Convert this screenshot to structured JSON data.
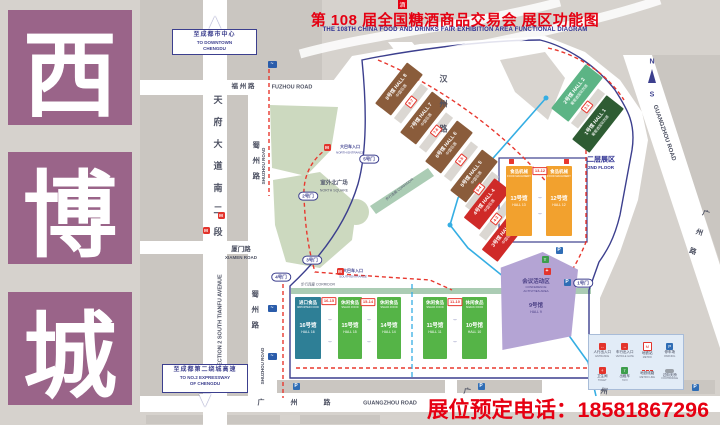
{
  "sidebar": {
    "chars": [
      "西",
      "博",
      "城"
    ],
    "color": "#9a6489"
  },
  "title": {
    "logo_glyph": "酒",
    "cn": "第 108 届全国糖酒商品交易会  展区功能图",
    "en": "THE 108TH CHINA FOOD AND DRINKS FAIR  EXHIBITION AREA FUNCTIONAL DIAGRAM"
  },
  "phone_label": "展位预定电话：18581867296",
  "map": {
    "halls": [
      {
        "id": "8",
        "x": 373,
        "y": 79,
        "w": 52,
        "h": 20,
        "r": -52,
        "color": "#8a5c3b",
        "lines": [
          {
            "t": "8号馆 HALL 8",
            "fs": 5,
            "b": 1
          },
          {
            "t": "中国名酒",
            "fs": 3.8,
            "mt": 1
          }
        ]
      },
      {
        "id": "7",
        "x": 398,
        "y": 108,
        "w": 52,
        "h": 20,
        "r": -52,
        "color": "#8a5c3b",
        "lines": [
          {
            "t": "7号馆 HALL 7",
            "fs": 5,
            "b": 1
          },
          {
            "t": "中国名酒",
            "fs": 3.8,
            "mt": 1
          }
        ]
      },
      {
        "id": "6",
        "x": 423,
        "y": 137,
        "w": 52,
        "h": 20,
        "r": -52,
        "color": "#8a5c3b",
        "lines": [
          {
            "t": "6号馆 HALL 6",
            "fs": 5,
            "b": 1
          },
          {
            "t": "中国名酒",
            "fs": 3.8,
            "mt": 1
          }
        ]
      },
      {
        "id": "5",
        "x": 448,
        "y": 166,
        "w": 52,
        "h": 20,
        "r": -52,
        "color": "#8a5c3b",
        "lines": [
          {
            "t": "5号馆 HALL 5",
            "fs": 5,
            "b": 1
          },
          {
            "t": "中国名酒",
            "fs": 3.8,
            "mt": 1
          }
        ]
      },
      {
        "id": "4",
        "x": 462,
        "y": 194,
        "w": 50,
        "h": 20,
        "r": -52,
        "color": "#cf2a28",
        "lines": [
          {
            "t": "4号馆 HALL 4",
            "fs": 5,
            "b": 1
          },
          {
            "t": "中国名酒",
            "fs": 3.8,
            "mt": 1
          }
        ]
      },
      {
        "id": "3",
        "x": 480,
        "y": 226,
        "w": 50,
        "h": 20,
        "r": -52,
        "color": "#cf2a28",
        "lines": [
          {
            "t": "3号馆 HALL 3",
            "fs": 5,
            "b": 1
          },
          {
            "t": "中国名酒",
            "fs": 3.8,
            "mt": 1
          }
        ]
      },
      {
        "id": "2",
        "x": 549,
        "y": 82,
        "w": 56,
        "h": 22,
        "r": -52,
        "color": "#5cb485",
        "lines": [
          {
            "t": "2号馆 HALL 2",
            "fs": 5,
            "b": 1
          },
          {
            "t": "葡萄酒国际烈酒",
            "fs": 3.6,
            "mt": 1
          }
        ]
      },
      {
        "id": "1",
        "x": 570,
        "y": 113,
        "w": 56,
        "h": 22,
        "r": -52,
        "color": "#2e5c33",
        "lines": [
          {
            "t": "1号馆 HALL 1",
            "fs": 5,
            "b": 1
          },
          {
            "t": "葡萄酒国际烈酒",
            "fs": 3.6,
            "mt": 1
          }
        ]
      },
      {
        "id": "9",
        "x": 494,
        "y": 252,
        "w": 84,
        "h": 98,
        "color": "#b4a4d4",
        "tc": "#4a3f85",
        "clip": "8% 16%, 58% 0%, 100% 18%, 92% 86%, 10% 100%",
        "lines": [
          {
            "t": "会议活动区",
            "fs": 5.5,
            "b": 1,
            "mt": 24
          },
          {
            "t": "CONFERENCE",
            "fs": 3
          },
          {
            "t": "ACTIVITIES AREA",
            "fs": 3
          },
          {
            "t": "9号馆",
            "fs": 5.5,
            "b": 1,
            "mt": 10
          },
          {
            "t": "HALL 9",
            "fs": 3.5
          }
        ]
      },
      {
        "id": "13",
        "x": 506,
        "y": 166,
        "w": 26,
        "h": 70,
        "color": "#f2a12e",
        "lines": [
          {
            "t": "食品机械",
            "fs": 4.5,
            "b": 1
          },
          {
            "t": "FOOD MACHINERY",
            "fs": 2.6
          },
          {
            "t": "13号馆",
            "fs": 5.5,
            "b": 1,
            "mt": 18
          },
          {
            "t": "HALL 13",
            "fs": 3.5
          }
        ]
      },
      {
        "id": "12",
        "x": 546,
        "y": 166,
        "w": 26,
        "h": 70,
        "color": "#f2a12e",
        "lines": [
          {
            "t": "食品机械",
            "fs": 4.5,
            "b": 1
          },
          {
            "t": "FOOD MACHINERY",
            "fs": 2.6
          },
          {
            "t": "12号馆",
            "fs": 5.5,
            "b": 1,
            "mt": 18
          },
          {
            "t": "HALL 12",
            "fs": 3.5
          }
        ]
      },
      {
        "id": "16",
        "x": 295,
        "y": 297,
        "w": 26,
        "h": 62,
        "color": "#2e7f96",
        "lines": [
          {
            "t": "进口食品",
            "fs": 4.5,
            "b": 1
          },
          {
            "t": "IMPORTED FOOD",
            "fs": 2.6
          },
          {
            "t": "16号馆",
            "fs": 5.5,
            "b": 1,
            "mt": 14
          },
          {
            "t": "HALL 16",
            "fs": 3.5
          }
        ]
      },
      {
        "id": "15",
        "x": 338,
        "y": 297,
        "w": 24,
        "h": 62,
        "color": "#55b447",
        "lines": [
          {
            "t": "休闲食品",
            "fs": 4.5,
            "b": 1
          },
          {
            "t": "SNACK FOOD",
            "fs": 2.6
          },
          {
            "t": "15号馆",
            "fs": 5.5,
            "b": 1,
            "mt": 14
          },
          {
            "t": "HALL 15",
            "fs": 3.5
          }
        ]
      },
      {
        "id": "14",
        "x": 377,
        "y": 297,
        "w": 24,
        "h": 62,
        "color": "#55b447",
        "lines": [
          {
            "t": "休闲食品",
            "fs": 4.5,
            "b": 1
          },
          {
            "t": "SNACK FOOD",
            "fs": 2.6
          },
          {
            "t": "14号馆",
            "fs": 5.5,
            "b": 1,
            "mt": 14
          },
          {
            "t": "HALL 14",
            "fs": 3.5
          }
        ]
      },
      {
        "id": "11",
        "x": 423,
        "y": 297,
        "w": 24,
        "h": 62,
        "color": "#55b447",
        "lines": [
          {
            "t": "休闲食品",
            "fs": 4.5,
            "b": 1
          },
          {
            "t": "SNACK FOOD",
            "fs": 2.6
          },
          {
            "t": "11号馆",
            "fs": 5.5,
            "b": 1,
            "mt": 14
          },
          {
            "t": "HALL 11",
            "fs": 3.5
          }
        ]
      },
      {
        "id": "10",
        "x": 462,
        "y": 297,
        "w": 25,
        "h": 62,
        "color": "#55b447",
        "lines": [
          {
            "t": "休闲食品",
            "fs": 4.5,
            "b": 1
          },
          {
            "t": "SNACK FOOD",
            "fs": 2.6
          },
          {
            "t": "10号馆",
            "fs": 5.5,
            "b": 1,
            "mt": 14
          },
          {
            "t": "HALL 10",
            "fs": 3.5
          }
        ]
      }
    ],
    "strips": [
      {
        "x": 411,
        "y": 103,
        "r": -52
      },
      {
        "x": 436,
        "y": 132,
        "r": -52
      },
      {
        "x": 461,
        "y": 161,
        "r": -52
      },
      {
        "x": 482,
        "y": 191,
        "r": -52
      },
      {
        "x": 496,
        "y": 220,
        "r": -52
      },
      {
        "x": 588,
        "y": 108,
        "r": -52
      }
    ],
    "connectors": [
      {
        "t": "16-15",
        "x": 329,
        "y": 301
      },
      {
        "t": "15-14",
        "x": 368,
        "y": 302
      },
      {
        "t": "11-10",
        "x": 455,
        "y": 302
      },
      {
        "t": "13-12",
        "x": 540,
        "y": 171
      },
      {
        "t": "2-1",
        "x": 587,
        "y": 107,
        "r": -52
      },
      {
        "t": "8-7",
        "x": 411,
        "y": 102,
        "r": -52
      },
      {
        "t": "7-6",
        "x": 436,
        "y": 131,
        "r": -52
      },
      {
        "t": "6-5",
        "x": 461,
        "y": 160,
        "r": -52
      },
      {
        "t": "5-4",
        "x": 479,
        "y": 189,
        "r": -52
      },
      {
        "t": "4-3",
        "x": 496,
        "y": 219,
        "r": -52
      }
    ],
    "gates": [
      {
        "label": "2号门",
        "x": 308,
        "y": 196
      },
      {
        "label": "3号门",
        "x": 312,
        "y": 260
      },
      {
        "label": "4号门",
        "x": 281,
        "y": 277
      },
      {
        "label": "1号门",
        "x": 583,
        "y": 283
      },
      {
        "label": "5号门",
        "x": 369,
        "y": 159
      }
    ],
    "labels": [
      {
        "t": "福 州 路",
        "x": 243,
        "y": 87,
        "fs": 6.5,
        "b": 1,
        "n": "road-label-fuzhou-cn"
      },
      {
        "t": "FUZHOU ROAD",
        "x": 292,
        "y": 88,
        "fs": 5.5,
        "b": 1,
        "n": "road-label-fuzhou-en"
      },
      {
        "t": "天府大道南二段",
        "x": 217,
        "y": 172,
        "fs": 9,
        "b": 1,
        "vert": 1,
        "ls": 13,
        "n": "road-label-tianfu-cn"
      },
      {
        "t": "SECTION 2 SOUTH TIANFU AVENUE",
        "x": 221,
        "y": 322,
        "fs": 5.5,
        "b": 1,
        "rot": -90,
        "n": "road-label-tianfu-en"
      },
      {
        "t": "蜀州路",
        "x": 256,
        "y": 164,
        "fs": 7.5,
        "b": 1,
        "vert": 1,
        "ls": 8,
        "n": "road-label-shuzhou-upper-cn"
      },
      {
        "t": "SHUZHOU ROAD",
        "x": 264,
        "y": 166,
        "fs": 4.5,
        "b": 1,
        "rot": -90,
        "n": "road-label-shuzhou-upper-en"
      },
      {
        "t": "蜀州路",
        "x": 255,
        "y": 313,
        "fs": 7.5,
        "b": 1,
        "vert": 1,
        "ls": 8,
        "n": "road-label-shuzhou-lower-cn"
      },
      {
        "t": "SHUZHOU ROAD",
        "x": 263,
        "y": 366,
        "fs": 4.5,
        "b": 1,
        "rot": -90,
        "n": "road-label-shuzhou-lower-en"
      },
      {
        "t": "厦门路",
        "x": 241,
        "y": 250,
        "fs": 6.5,
        "b": 1,
        "n": "road-label-xiamen-cn"
      },
      {
        "t": "XIAMEN ROAD",
        "x": 241,
        "y": 258,
        "fs": 4.5,
        "b": 1,
        "n": "road-label-xiamen-en"
      },
      {
        "t": "汉州路",
        "x": 443,
        "y": 112,
        "fs": 8,
        "b": 1,
        "vert": 1,
        "ls": 17,
        "n": "road-label-hanzhou-cn"
      },
      {
        "t": "广 州 路",
        "x": 300,
        "y": 403,
        "fs": 7,
        "b": 1,
        "ls": 12,
        "n": "road-label-guangzhou-s-cn"
      },
      {
        "t": "GUANGZHOU ROAD",
        "x": 390,
        "y": 404,
        "fs": 5.5,
        "b": 1,
        "n": "road-label-guangzhou-s-en"
      },
      {
        "t": "广",
        "x": 467,
        "y": 392,
        "fs": 7,
        "b": 1,
        "rot": 8,
        "n": "road-char-guang"
      },
      {
        "t": "州",
        "x": 604,
        "y": 392,
        "fs": 7,
        "b": 1,
        "rot": 8,
        "n": "road-char-zhou"
      },
      {
        "t": "GUANGZHOU ROAD",
        "x": 664,
        "y": 133,
        "fs": 6,
        "b": 1,
        "rot": 71,
        "n": "road-label-guangzhou-diag-en"
      },
      {
        "t": "广州路",
        "x": 697,
        "y": 238,
        "fs": 7,
        "b": 1,
        "vert": 1,
        "ls": 13,
        "rot": 19,
        "n": "road-label-guangzhou-diag-cn"
      },
      {
        "t": "室外北广场",
        "x": 334,
        "y": 184,
        "fs": 5.5,
        "b": 1,
        "c": "#565b70",
        "n": "north-square-label-cn"
      },
      {
        "t": "NORTH SQUARE",
        "x": 334,
        "y": 191,
        "fs": 3.5,
        "c": "#565b70",
        "n": "north-square-label-en"
      },
      {
        "t": "二层展区",
        "x": 601,
        "y": 160,
        "fs": 7,
        "b": 1,
        "c": "#2e3192",
        "n": "second-floor-label-cn"
      },
      {
        "t": "2ND FLOOR",
        "x": 601,
        "y": 168,
        "fs": 4.5,
        "b": 1,
        "c": "#2e3192",
        "n": "second-floor-label-en"
      },
      {
        "t": "步行连廊 CORRIDOR",
        "x": 400,
        "y": 190,
        "fs": 3.5,
        "rot": -38,
        "c": "#565b70",
        "n": "corridor-label-diag"
      },
      {
        "t": "步行连廊 CORRIDOR",
        "x": 318,
        "y": 285,
        "fs": 3.5,
        "c": "#565b70",
        "n": "corridor-label-south"
      },
      {
        "t": "大巴车入口",
        "x": 350,
        "y": 147,
        "fs": 4,
        "b": 1,
        "c": "#3c3f8e",
        "n": "north-entrance-label-cn"
      },
      {
        "t": "NORTH ENTRANCE",
        "x": 350,
        "y": 153,
        "fs": 3,
        "c": "#3c3f8e",
        "n": "north-entrance-label-en"
      },
      {
        "t": "大巴车入口",
        "x": 353,
        "y": 271,
        "fs": 4,
        "b": 1,
        "c": "#3c3f8e",
        "n": "south-entrance-label-cn"
      },
      {
        "t": "SOUTH ENTRANCE",
        "x": 353,
        "y": 277,
        "fs": 3,
        "c": "#3c3f8e",
        "n": "south-entrance-label-en"
      },
      {
        "t": "N",
        "x": 652,
        "y": 62,
        "fs": 7,
        "b": 1,
        "c": "#3c3f8e",
        "n": "compass-n"
      },
      {
        "t": "S",
        "x": 652,
        "y": 95,
        "fs": 7,
        "b": 1,
        "c": "#3c3f8e",
        "n": "compass-s"
      },
      {
        "t": "↔",
        "x": 330,
        "y": 320,
        "fs": 5,
        "c": "#3c3f8e",
        "n": "corridor-arrow"
      },
      {
        "t": "↔",
        "x": 330,
        "y": 342,
        "fs": 5,
        "c": "#3c3f8e",
        "n": "corridor-arrow"
      },
      {
        "t": "↔",
        "x": 369,
        "y": 320,
        "fs": 5,
        "c": "#3c3f8e",
        "n": "corridor-arrow"
      },
      {
        "t": "↔",
        "x": 369,
        "y": 342,
        "fs": 5,
        "c": "#3c3f8e",
        "n": "corridor-arrow"
      },
      {
        "t": "↔",
        "x": 455,
        "y": 320,
        "fs": 5,
        "c": "#3c3f8e",
        "n": "corridor-arrow"
      },
      {
        "t": "↔",
        "x": 455,
        "y": 342,
        "fs": 5,
        "c": "#3c3f8e",
        "n": "corridor-arrow"
      },
      {
        "t": "↔",
        "x": 540,
        "y": 198,
        "fs": 5,
        "c": "#3c3f8e",
        "n": "corridor-arrow"
      },
      {
        "t": "↔",
        "x": 540,
        "y": 214,
        "fs": 5,
        "c": "#3c3f8e",
        "n": "corridor-arrow"
      }
    ],
    "icons": [
      {
        "tp": "metro",
        "x": 221,
        "y": 215
      },
      {
        "tp": "metro",
        "x": 206,
        "y": 230
      },
      {
        "tp": "metro",
        "x": 327,
        "y": 147
      },
      {
        "tp": "metro",
        "x": 340,
        "y": 271
      },
      {
        "tp": "park",
        "x": 296,
        "y": 386
      },
      {
        "tp": "park",
        "x": 481,
        "y": 386
      },
      {
        "tp": "park",
        "x": 695,
        "y": 387
      },
      {
        "tp": "park",
        "x": 559,
        "y": 250
      },
      {
        "tp": "park",
        "x": 567,
        "y": 282
      },
      {
        "tp": "taxi",
        "x": 545,
        "y": 259
      },
      {
        "tp": "aid",
        "x": 547,
        "y": 271
      },
      {
        "tp": "flag",
        "x": 272,
        "y": 64
      },
      {
        "tp": "flag",
        "x": 272,
        "y": 308
      },
      {
        "tp": "flag",
        "x": 272,
        "y": 356
      },
      {
        "tp": "exit",
        "x": 511,
        "y": 161
      },
      {
        "tp": "exit",
        "x": 566,
        "y": 161
      }
    ],
    "signs": [
      {
        "lines": [
          "至成都市中心",
          "TO DOWNTOWN",
          "CHENGDU"
        ],
        "x": 172,
        "y": 29,
        "w": 85,
        "h": 26,
        "arrow": "up"
      },
      {
        "lines": [
          "至成都第二绕城高速",
          "TO NO.2 EXPRESSWAY",
          "OF CHENGDU"
        ],
        "x": 162,
        "y": 364,
        "w": 86,
        "h": 29,
        "arrow": "down"
      }
    ]
  },
  "legend": {
    "items": [
      {
        "i": "red",
        "cn": "人行出入口",
        "en": "ENTRANCE"
      },
      {
        "i": "red",
        "cn": "车行出入口",
        "en": "VEHICLE GATE"
      },
      {
        "i": "redo",
        "cn": "地铁站",
        "en": "METRO"
      },
      {
        "i": "bluep",
        "cn": "停车场",
        "en": "PARKING"
      },
      {
        "i": "red2",
        "cn": "卫生间",
        "en": "TOILET"
      },
      {
        "i": "green",
        "cn": "出租车",
        "en": "TAXI"
      },
      {
        "i": "dash",
        "cn": "地铁线路",
        "en": "METRO LINE"
      },
      {
        "i": "gray",
        "cn": "过街天桥",
        "en": "FOOTBRIDGE"
      }
    ]
  }
}
